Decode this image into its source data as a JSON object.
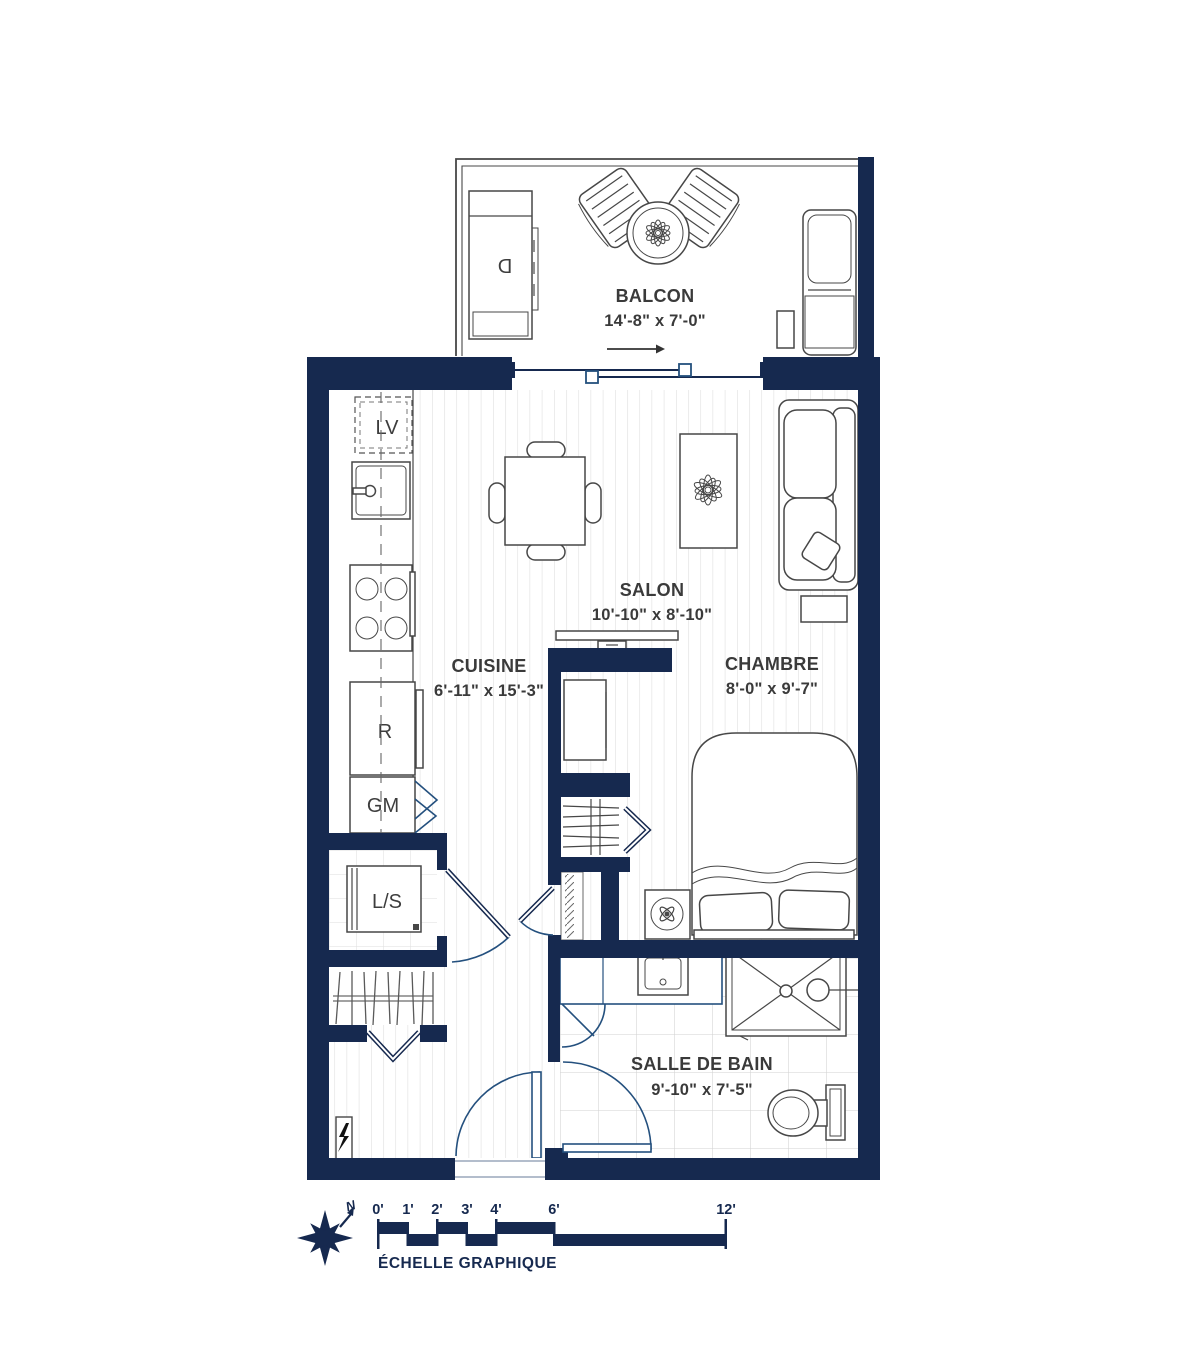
{
  "plan": {
    "rooms": [
      {
        "name": "BALCON",
        "dims": "14'-8\" x 7'-0\""
      },
      {
        "name": "SALON",
        "dims": "10'-10\" x 8'-10\""
      },
      {
        "name": "CUISINE",
        "dims": "6'-11\" x 15'-3\""
      },
      {
        "name": "CHAMBRE",
        "dims": "8'-0\" x 9'-7\""
      },
      {
        "name": "SALLE DE BAIN",
        "dims": "9'-10\" x 7'-5\""
      }
    ],
    "fixtures": {
      "dishwasher": "LV",
      "fridge": "R",
      "pantry": "GM",
      "washer_dryer": "L/S",
      "bbq": "D"
    }
  },
  "scale": {
    "title": "ÉCHELLE GRAPHIQUE",
    "north": "N",
    "ticks": [
      "0'",
      "1'",
      "2'",
      "3'",
      "4'",
      "6'",
      "12'"
    ]
  },
  "colors": {
    "navy": "#16294f",
    "door": "#24507e",
    "label": "#3a3a3a",
    "furniture": "#474747",
    "floorline": "#dcdcdc",
    "tileline": "#d2d2d2"
  }
}
